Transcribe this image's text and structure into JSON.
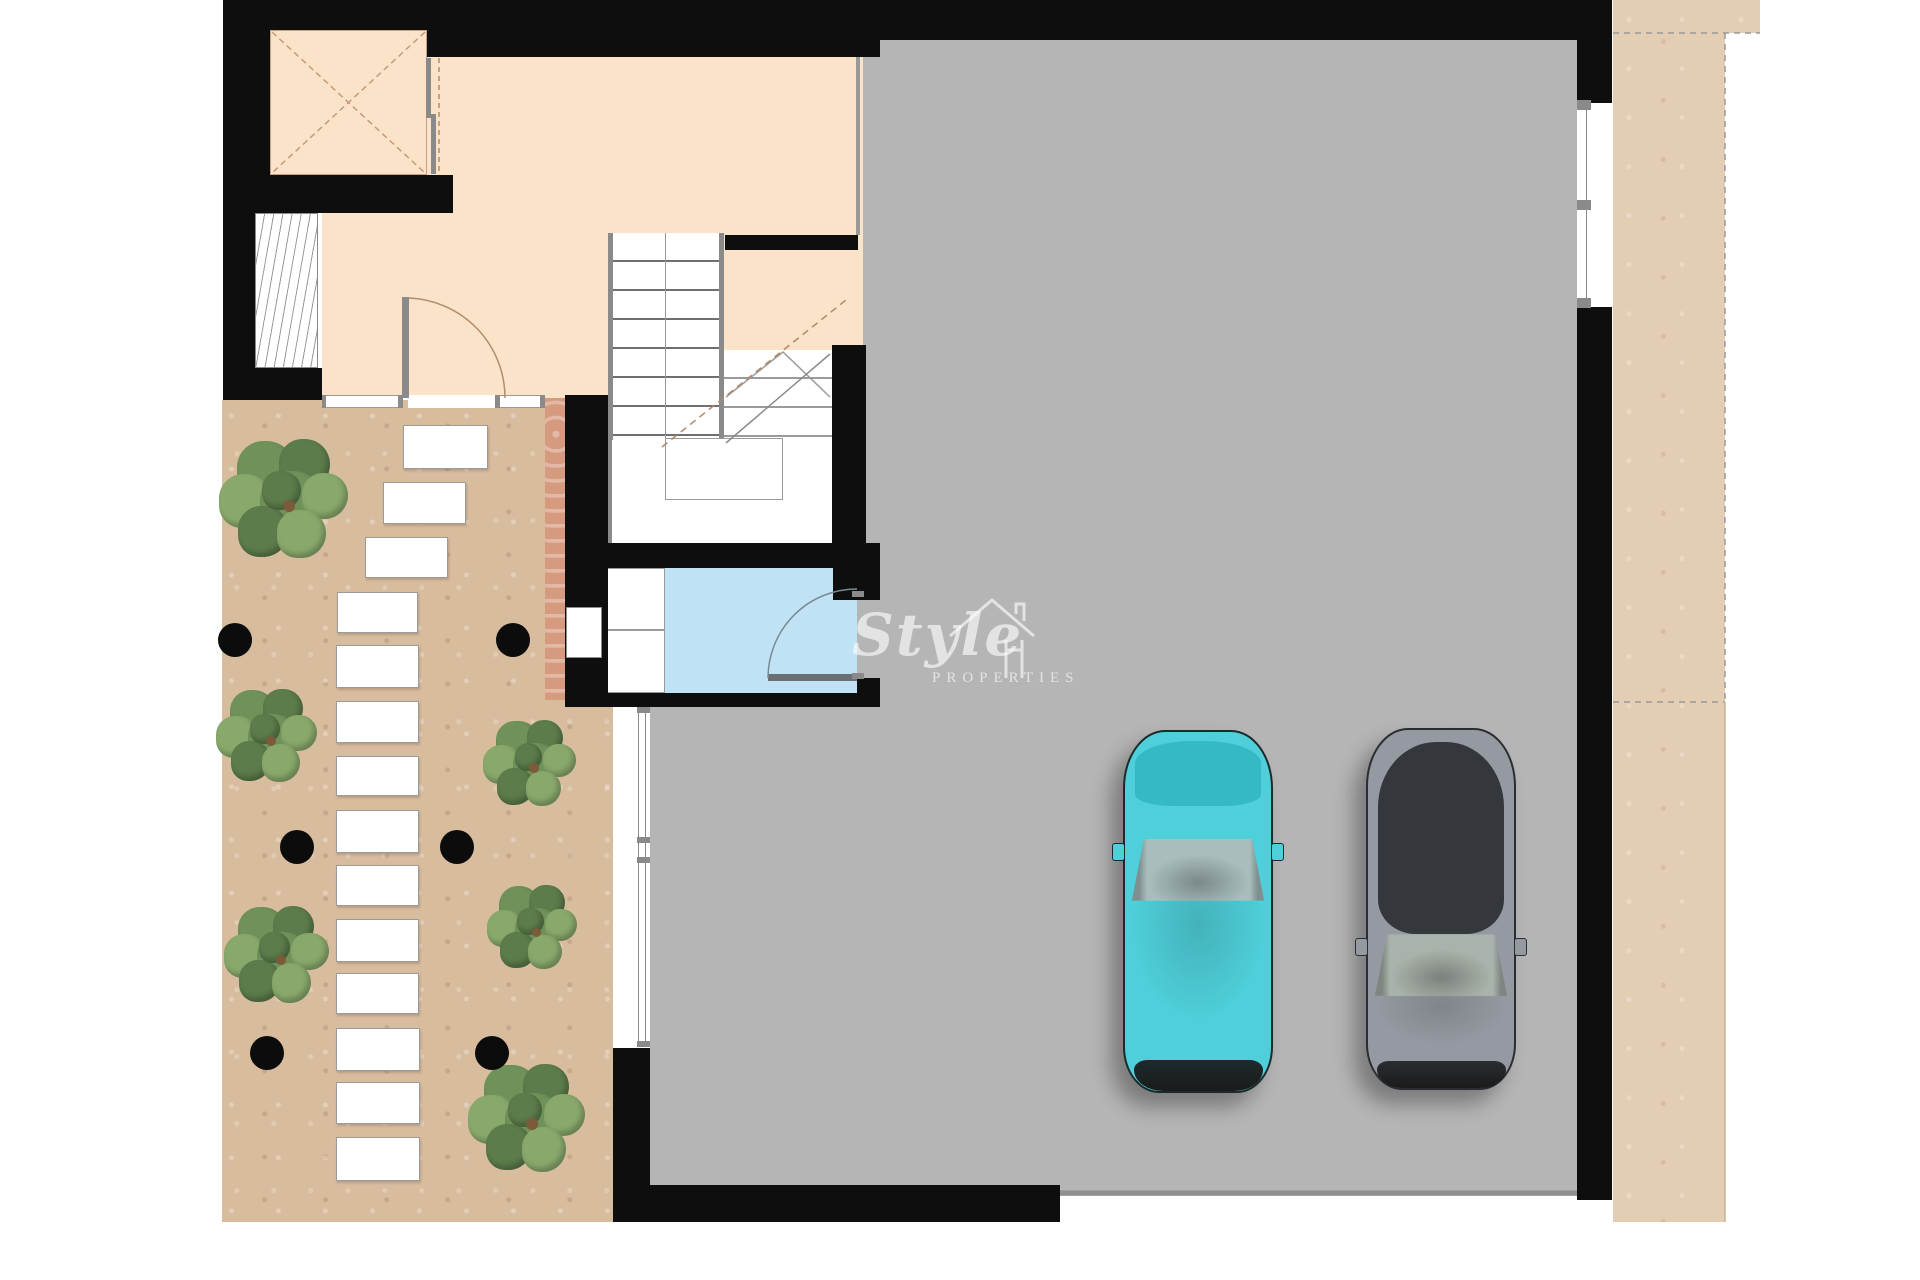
{
  "watermark": {
    "brand": "Style",
    "subtitle": "PROPERTIES"
  },
  "colors": {
    "wall": "#0e0e0e",
    "garage": "#b5b5b5",
    "peach": "#fbe3c9",
    "garden": "#d8bc9e",
    "garden_right": "#e3cdb3",
    "salmon": "#d69b7f",
    "blue": "#bfe2f4",
    "frame": "#8a8a8a",
    "line": "#999999",
    "tree_dark": "#5c7c4b",
    "tree_mid": "#6f925a",
    "tree_light": "#89a96c",
    "trunk": "#7a5b3a"
  },
  "garden": {
    "stepping_stones": [
      {
        "x": 403,
        "y": 425,
        "w": 85,
        "h": 44
      },
      {
        "x": 383,
        "y": 482,
        "w": 83,
        "h": 42
      },
      {
        "x": 365,
        "y": 537,
        "w": 83,
        "h": 41
      },
      {
        "x": 337,
        "y": 592,
        "w": 81,
        "h": 41
      },
      {
        "x": 336,
        "y": 645,
        "w": 83,
        "h": 43
      },
      {
        "x": 336,
        "y": 701,
        "w": 83,
        "h": 42
      },
      {
        "x": 336,
        "y": 756,
        "w": 83,
        "h": 40
      },
      {
        "x": 336,
        "y": 810,
        "w": 83,
        "h": 43
      },
      {
        "x": 336,
        "y": 865,
        "w": 83,
        "h": 41
      },
      {
        "x": 336,
        "y": 919,
        "w": 83,
        "h": 43
      },
      {
        "x": 336,
        "y": 973,
        "w": 83,
        "h": 41
      },
      {
        "x": 336,
        "y": 1028,
        "w": 84,
        "h": 43
      },
      {
        "x": 336,
        "y": 1082,
        "w": 84,
        "h": 42
      },
      {
        "x": 336,
        "y": 1137,
        "w": 84,
        "h": 44
      }
    ],
    "trees": [
      {
        "cx": 289,
        "cy": 506,
        "size": 128
      },
      {
        "cx": 271,
        "cy": 741,
        "size": 100
      },
      {
        "cx": 281,
        "cy": 960,
        "size": 104
      },
      {
        "cx": 534,
        "cy": 768,
        "size": 92
      },
      {
        "cx": 536,
        "cy": 932,
        "size": 90
      },
      {
        "cx": 532,
        "cy": 1124,
        "size": 116
      }
    ],
    "spotlights": [
      {
        "cx": 235,
        "cy": 640
      },
      {
        "cx": 513,
        "cy": 640
      },
      {
        "cx": 297,
        "cy": 847
      },
      {
        "cx": 457,
        "cy": 847
      },
      {
        "cx": 267,
        "cy": 1053
      },
      {
        "cx": 492,
        "cy": 1053
      }
    ]
  },
  "garage": {
    "cars": [
      {
        "name": "car-teal",
        "x": 1123,
        "y": 730,
        "w": 150,
        "h": 363,
        "body": "#4ecfd9",
        "roof": "#35b9c5",
        "glass": "#a9bdbd",
        "trim": "#1d2a2c",
        "dark_top": [
          0.03,
          0.21
        ],
        "shield": [
          0.3,
          0.47
        ],
        "hood": [
          0.47,
          0.9
        ],
        "front": [
          0.91,
          0.995
        ],
        "mirror": 0.31
      },
      {
        "name": "car-gray",
        "x": 1366,
        "y": 728,
        "w": 150,
        "h": 362,
        "body": "#959aa2",
        "roof": "#34373c",
        "glass": "#aab3ab",
        "trim": "#2a2d31",
        "dark_top": [
          0.04,
          0.57
        ],
        "shield": [
          0.57,
          0.74
        ],
        "hood": [
          0.74,
          0.92
        ],
        "front": [
          0.92,
          0.995
        ],
        "mirror": 0.58
      }
    ]
  }
}
